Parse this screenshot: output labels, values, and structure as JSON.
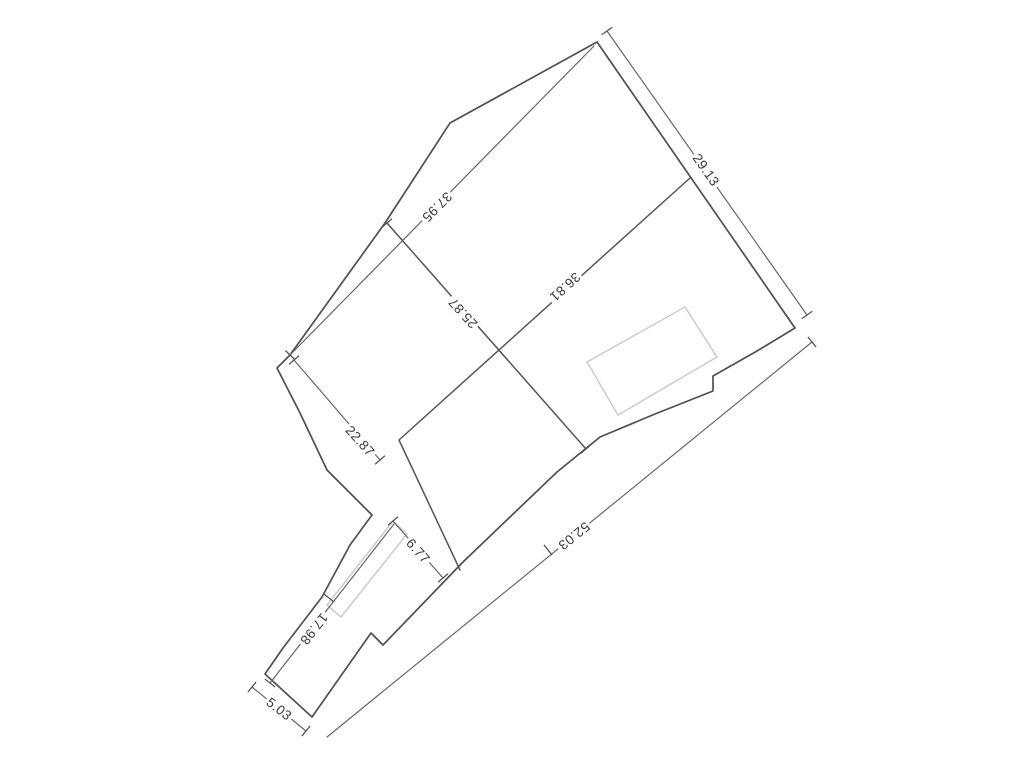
{
  "canvas": {
    "background": "#ffffff"
  },
  "colors": {
    "boundary_line": "#4f4f54",
    "lot_line": "#55555a",
    "dimension_line": "#65656a",
    "building_outline": "#cbcbce",
    "label_text": "#38383c",
    "label_background": "#ffffff"
  },
  "plan": {
    "type": "cadastral-parcel-survey-drawing",
    "dimension_labels": [
      {
        "id": "dim-29-13",
        "value": "29.13"
      },
      {
        "id": "dim-37-95",
        "value": "37.95"
      },
      {
        "id": "dim-25-87",
        "value": "25.87"
      },
      {
        "id": "dim-36-81",
        "value": "36.81"
      },
      {
        "id": "dim-22-87",
        "value": "22.87"
      },
      {
        "id": "dim-6-77",
        "value": "6.77"
      },
      {
        "id": "dim-17-98",
        "value": "17.98"
      },
      {
        "id": "dim-5-03",
        "value": "5.03"
      },
      {
        "id": "dim-52-03",
        "value": "52.03"
      }
    ]
  }
}
